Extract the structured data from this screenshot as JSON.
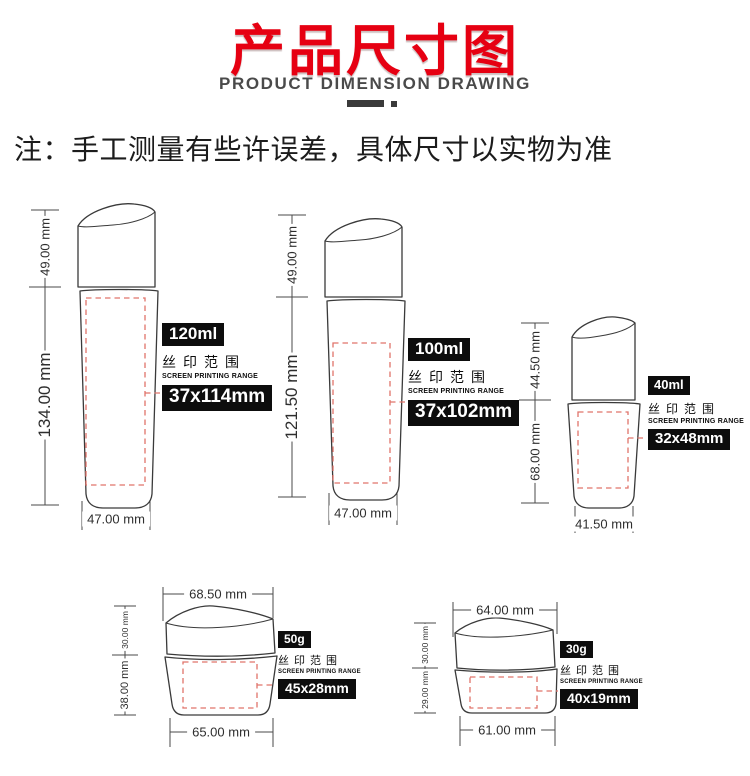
{
  "header": {
    "title": "产品尺寸图",
    "subtitle": "PRODUCT DIMENSION DRAWING",
    "note": "注：手工测量有些许误差，具体尺寸以实物为准"
  },
  "colors": {
    "accent_red": "#e60012",
    "dashed_red": "#e0736a",
    "outline_gray": "#3a3a3a",
    "badge_black": "#0d0d0d"
  },
  "products": [
    {
      "id": "bottle-120ml",
      "volume": "120ml",
      "silk_label": "丝印范围",
      "silk_label_en": "SCREEN PRINTING RANGE",
      "print_area": "37x114mm",
      "dims": {
        "cap_height": "49.00 mm",
        "total_height": "134.00 mm",
        "width": "47.00 mm"
      }
    },
    {
      "id": "bottle-100ml",
      "volume": "100ml",
      "silk_label": "丝印范围",
      "silk_label_en": "SCREEN PRINTING RANGE",
      "print_area": "37x102mm",
      "dims": {
        "cap_height": "49.00 mm",
        "total_height": "121.50 mm",
        "width": "47.00 mm"
      }
    },
    {
      "id": "bottle-40ml",
      "volume": "40ml",
      "silk_label": "丝印范围",
      "silk_label_en": "SCREEN PRINTING RANGE",
      "print_area": "32x48mm",
      "dims": {
        "cap_height": "44.50 mm",
        "body_height": "68.00 mm",
        "width": "41.50 mm"
      }
    },
    {
      "id": "jar-50g",
      "volume": "50g",
      "silk_label": "丝印范围",
      "silk_label_en": "SCREEN PRINTING RANGE",
      "print_area": "45x28mm",
      "dims": {
        "top_width": "68.50 mm",
        "cap_height": "30.00 mm",
        "body_height": "38.00 mm",
        "bottom_width": "65.00 mm"
      }
    },
    {
      "id": "jar-30g",
      "volume": "30g",
      "silk_label": "丝印范围",
      "silk_label_en": "SCREEN PRINTING RANGE",
      "print_area": "40x19mm",
      "dims": {
        "top_width": "64.00 mm",
        "cap_height": "30.00 mm",
        "body_height": "29.00 mm",
        "bottom_width": "61.00 mm"
      }
    }
  ]
}
